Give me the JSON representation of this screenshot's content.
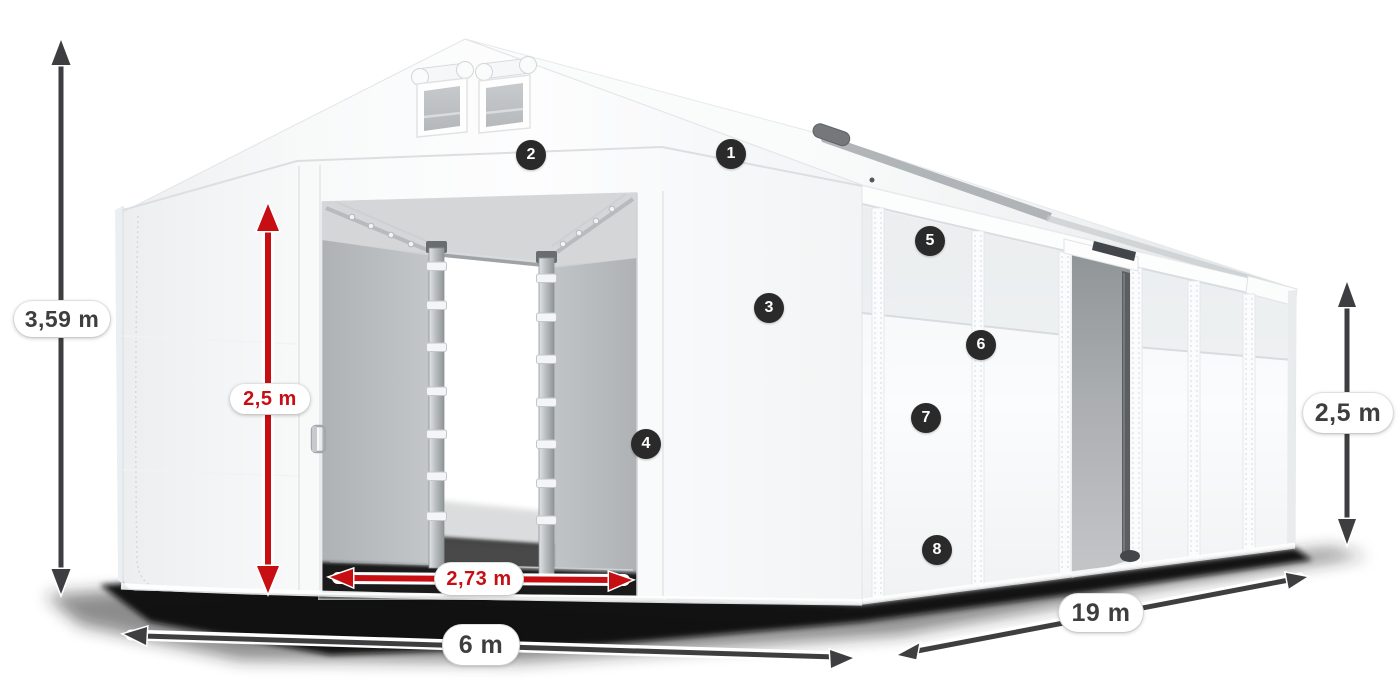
{
  "page": {
    "background_color": "#ffffff",
    "subject": "White tarpaulin storage tent with gable roof, open front sliding doors, side door, dimension arrows and numbered feature callouts"
  },
  "colors": {
    "dimension_dark": "#3e3e40",
    "dimension_red": "#c70e13",
    "pill_background": "#ffffff",
    "badge_background": "#2a2a2b",
    "badge_text": "#ffffff",
    "tent_white": "#fdfdfe",
    "interior_gray": "#b8bbbe",
    "shadow_black": "#0d0d0d"
  },
  "dimensions": {
    "total_height": {
      "label": "3,59 m",
      "style": "dark",
      "orientation": "vertical"
    },
    "door_height": {
      "label": "2,5 m",
      "style": "red",
      "orientation": "vertical"
    },
    "door_width": {
      "label": "2,73 m",
      "style": "red",
      "orientation": "horizontal"
    },
    "front_width": {
      "label": "6 m",
      "style": "dark",
      "orientation": "horizontal"
    },
    "side_length": {
      "label": "19 m",
      "style": "dark",
      "orientation": "diagonal"
    },
    "side_height": {
      "label": "2,5 m",
      "style": "dark",
      "orientation": "vertical"
    }
  },
  "callouts": {
    "items": [
      {
        "number": "1"
      },
      {
        "number": "2"
      },
      {
        "number": "3"
      },
      {
        "number": "4"
      },
      {
        "number": "5"
      },
      {
        "number": "6"
      },
      {
        "number": "7"
      },
      {
        "number": "8"
      }
    ]
  }
}
